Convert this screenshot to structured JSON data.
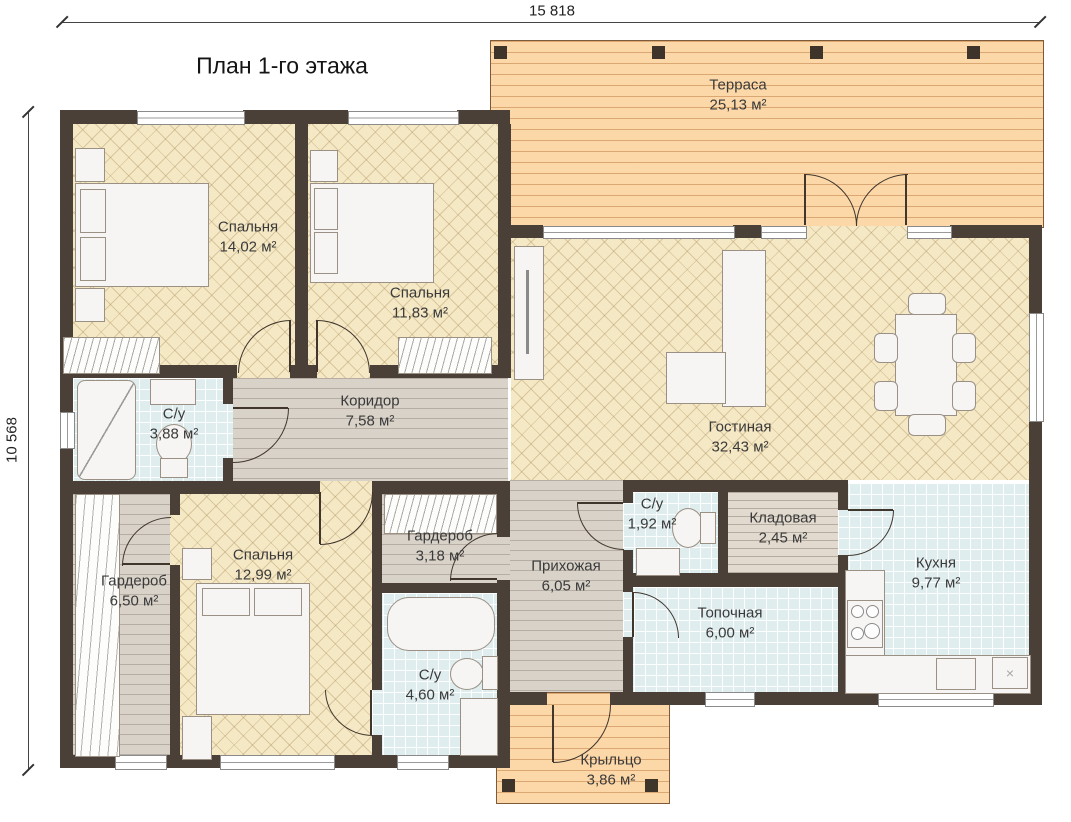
{
  "title": "План 1-го этажа",
  "dimensions": {
    "width_mm": "15 818",
    "height_mm": "10 568"
  },
  "rooms": [
    {
      "name": "Терраса",
      "area": "25,13 м²"
    },
    {
      "name": "Спальня",
      "area": "14,02 м²"
    },
    {
      "name": "Спальня",
      "area": "11,83 м²"
    },
    {
      "name": "С/у",
      "area": "3,88 м²"
    },
    {
      "name": "Коридор",
      "area": "7,58 м²"
    },
    {
      "name": "Гостиная",
      "area": "32,43 м²"
    },
    {
      "name": "Гардероб",
      "area": "6,50 м²"
    },
    {
      "name": "Спальня",
      "area": "12,99 м²"
    },
    {
      "name": "Гардероб",
      "area": "3,18 м²"
    },
    {
      "name": "С/у",
      "area": "4,60 м²"
    },
    {
      "name": "Прихожая",
      "area": "6,05 м²"
    },
    {
      "name": "С/у",
      "area": "1,92 м²"
    },
    {
      "name": "Кладовая",
      "area": "2,45 м²"
    },
    {
      "name": "Топочная",
      "area": "6,00 м²"
    },
    {
      "name": "Кухня",
      "area": "9,77 м²"
    },
    {
      "name": "Крыльцо",
      "area": "3,86 м²"
    }
  ],
  "icons": {
    "x_unit": "×"
  },
  "colors": {
    "wall": "#4b4037",
    "parquet_floor": "#f5e8c5",
    "deck_wood": "#fcd8a9",
    "plank_floor": "#d9d2c9",
    "tile_floor": "#dfedef",
    "pantry_floor": "#e2dacf",
    "label_text": "#3a3a3a"
  }
}
